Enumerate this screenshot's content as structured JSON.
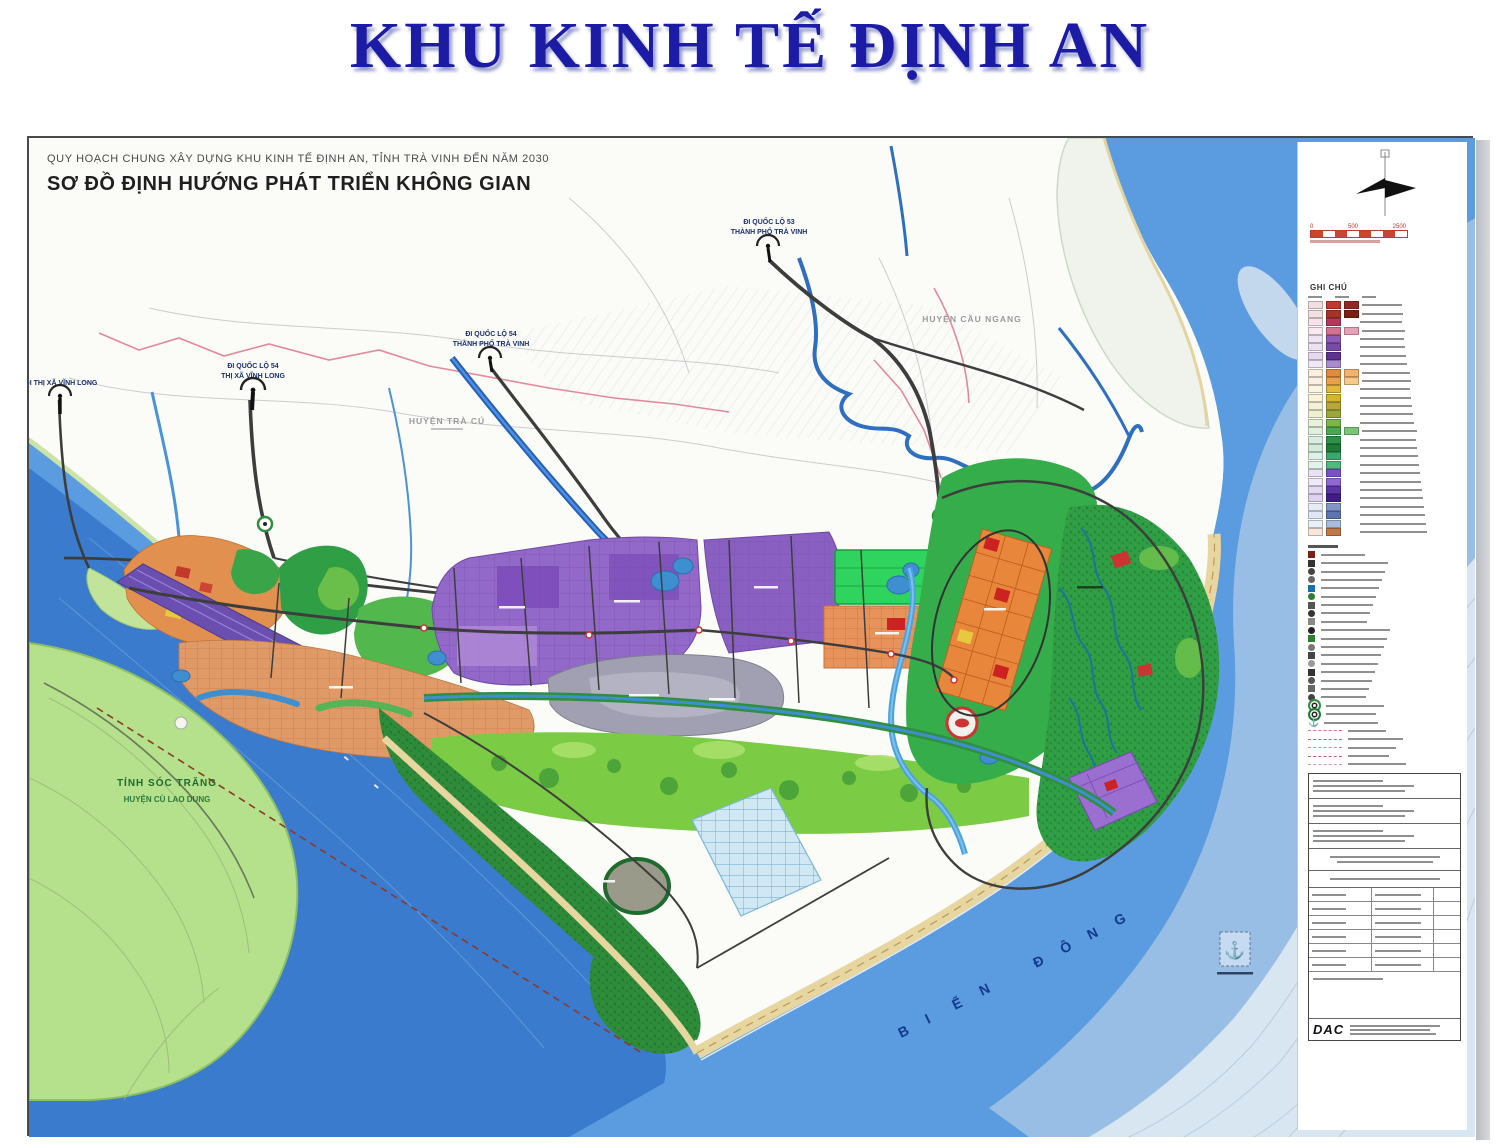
{
  "page": {
    "title": "KHU KINH TẾ ĐỊNH AN"
  },
  "map": {
    "header_line1": "QUY HOẠCH CHUNG XÂY DỰNG KHU KINH TẾ ĐỊNH AN, TỈNH TRÀ VINH ĐẾN NĂM 2030",
    "header_line2": "SƠ ĐỒ ĐỊNH HƯỚNG PHÁT TRIỂN KHÔNG GIAN",
    "labels": {
      "vinh_long_town": "ĐI THỊ XÃ VĨNH LONG",
      "ql54_a1": "ĐI QUỐC LỘ 54",
      "ql54_a2": "THỊ XÃ VĨNH LONG",
      "ql54_b1": "ĐI QUỐC LỘ 54",
      "ql54_b2": "THÀNH PHỐ TRÀ VINH",
      "ql53_1": "ĐI QUỐC LỘ 53",
      "ql53_2": "THÀNH PHỐ TRÀ VINH",
      "huyen_tra_cu": "HUYỆN TRÀ CÚ",
      "huyen_cau_ngang": "HUYỆN CẦU NGANG",
      "tinh_soc_trang": "TỈNH SÓC TRĂNG",
      "huyen_cu_lao_dung": "HUYỆN CÙ LAO DUNG",
      "bien_dong": "BIỂN ĐÔNG"
    }
  },
  "legend": {
    "title": "GHI CHÚ",
    "scale_ticks": [
      "0",
      "500",
      "2500"
    ],
    "logo": "DAC",
    "zone_rows": [
      {
        "c1": "#f2dede",
        "c2": "#c0392b",
        "c3": "#8e2a20"
      },
      {
        "c1": "#f5e0e0",
        "c2": "#a93226",
        "c3": "#7a1f16"
      },
      {
        "c1": "#f7e3ea",
        "c2": "#b03a5b",
        "c3": null
      },
      {
        "c1": "#f8e8ef",
        "c2": "#d4718f",
        "c3": "#e7a0b8"
      },
      {
        "c1": "#efe4f5",
        "c2": "#8e5bb5",
        "c3": null
      },
      {
        "c1": "#ece0f3",
        "c2": "#7a4aa8",
        "c3": null
      },
      {
        "c1": "#e6d8f0",
        "c2": "#5e3390",
        "c3": null
      },
      {
        "c1": "#f0e8f7",
        "c2": "#a98bd0",
        "c3": null
      },
      {
        "c1": "#fdeede",
        "c2": "#e08a3c",
        "c3": "#f5b26b"
      },
      {
        "c1": "#fdf0e0",
        "c2": "#e8a04a",
        "c3": "#f7c98a"
      },
      {
        "c1": "#fdf5df",
        "c2": "#e2b93b",
        "c3": null
      },
      {
        "c1": "#fbf3d8",
        "c2": "#d4b52f",
        "c3": null
      },
      {
        "c1": "#f5f0d5",
        "c2": "#b5a93a",
        "c3": null
      },
      {
        "c1": "#eef0d0",
        "c2": "#9aa83a",
        "c3": null
      },
      {
        "c1": "#e8f2d8",
        "c2": "#7ab648",
        "c3": null
      },
      {
        "c1": "#e0f0dc",
        "c2": "#4aa852",
        "c3": "#7cc578"
      },
      {
        "c1": "#d8eede",
        "c2": "#2f9145",
        "c3": null
      },
      {
        "c1": "#d2ead8",
        "c2": "#1e7a35",
        "c3": null
      },
      {
        "c1": "#dcf0e4",
        "c2": "#3aa86a",
        "c3": null
      },
      {
        "c1": "#e2f4ea",
        "c2": "#52b87e",
        "c3": null
      },
      {
        "c1": "#e9e2f6",
        "c2": "#7a52c8",
        "c3": null
      },
      {
        "c1": "#efe8f9",
        "c2": "#8f68d6",
        "c3": null
      },
      {
        "c1": "#e4daf2",
        "c2": "#5c35a8",
        "c3": null
      },
      {
        "c1": "#ded2ee",
        "c2": "#3f2080",
        "c3": null
      },
      {
        "c1": "#e6ebf6",
        "c2": "#8096c8",
        "c3": null
      },
      {
        "c1": "#dfe6f4",
        "c2": "#5c74b0",
        "c3": null
      },
      {
        "c1": "#eaf0fa",
        "c2": "#a8bcdc",
        "c3": null
      },
      {
        "c1": "#f7e6da",
        "c2": "#c07848",
        "c3": null
      }
    ],
    "symbol_rows": [
      {
        "shape": "sq",
        "color": "#7a1f16"
      },
      {
        "shape": "sq",
        "color": "#333333"
      },
      {
        "shape": "ci",
        "color": "#444444"
      },
      {
        "shape": "ci",
        "color": "#666666"
      },
      {
        "shape": "sq",
        "color": "#1a6faf"
      },
      {
        "shape": "ci",
        "color": "#2e7d32"
      },
      {
        "shape": "sq",
        "color": "#555555"
      },
      {
        "shape": "ci",
        "color": "#333333"
      },
      {
        "shape": "sq",
        "color": "#888888"
      },
      {
        "shape": "ci",
        "color": "#222222"
      },
      {
        "shape": "sq",
        "color": "#2e7d32"
      },
      {
        "shape": "ci",
        "color": "#777777"
      },
      {
        "shape": "sq",
        "color": "#444444"
      },
      {
        "shape": "ci",
        "color": "#999999"
      },
      {
        "shape": "sq",
        "color": "#333333"
      },
      {
        "shape": "ci",
        "color": "#555555"
      },
      {
        "shape": "sq",
        "color": "#666666"
      },
      {
        "shape": "ci",
        "color": "#444444"
      }
    ],
    "dashed_rows": [
      "#d87090",
      "#c05f7a",
      "#cc8899",
      "#b06080",
      "#d898a8"
    ]
  },
  "palette": {
    "sea_deep": "#3b7bce",
    "sea_mid": "#5b9be0",
    "sea_shallow": "#9cc0e6",
    "island_green": "#b5e08c",
    "industry_purple": "#9268c8",
    "residential_orange": "#e8935c",
    "urban_green": "#35ad4a",
    "mangrove_green": "#2e8b3a",
    "port_gray": "#a0a0b2",
    "beach_sand": "#e8d6a0",
    "road_dark": "#3d3d3d",
    "boundary_pink": "#e2899b",
    "title_blue": "#1b1ba6"
  }
}
